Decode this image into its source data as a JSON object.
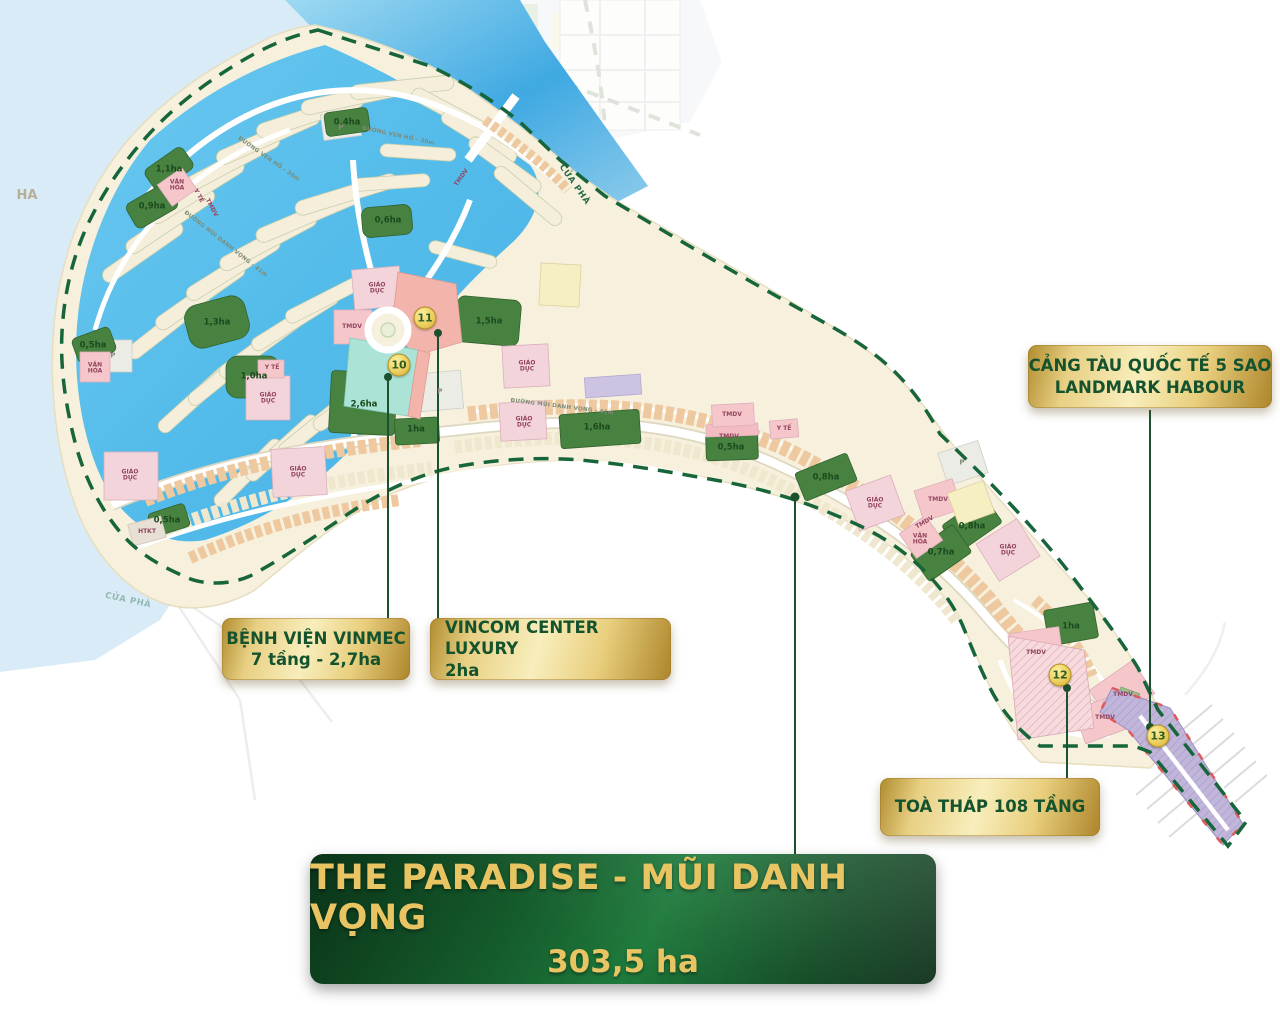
{
  "banner": {
    "title": "THE PARADISE - MŨI DANH VỌNG",
    "area": "303,5 ha"
  },
  "callouts": {
    "port": {
      "line1": "CẢNG TÀU QUỐC TẾ 5 SAO",
      "line2": "LANDMARK HABOUR"
    },
    "hospital": {
      "line1": "BỆNH VIỆN VINMEC",
      "line2": "7 tầng - 2,7ha"
    },
    "vincom": {
      "line1": "VINCOM CENTER LUXURY",
      "line2": "2ha"
    },
    "tower": {
      "line1": "TOÀ THÁP 108 TẦNG"
    }
  },
  "colors": {
    "badge_gold": "#e9cf7e",
    "badge_text": "#14532d",
    "banner_green": "#155c2c",
    "banner_text": "#e9c463",
    "boundary_green": "#17653a",
    "lagoon_blue": "#58bfec",
    "land_cream": "#f6f0dd",
    "leader_green": "#1c5130"
  },
  "map": {
    "markers": [
      {
        "label": "10",
        "x": 399,
        "y": 365
      },
      {
        "label": "11",
        "x": 425,
        "y": 318
      },
      {
        "label": "12",
        "x": 1060,
        "y": 675
      },
      {
        "label": "13",
        "x": 1158,
        "y": 736
      }
    ],
    "labels": [
      {
        "t": "1,1ha",
        "x": 169,
        "y": 170,
        "c": "green"
      },
      {
        "t": "0,9ha",
        "x": 152,
        "y": 207,
        "c": "green"
      },
      {
        "t": "0,4ha",
        "x": 347,
        "y": 123,
        "c": "green"
      },
      {
        "t": "0,6ha",
        "x": 388,
        "y": 221,
        "c": "green"
      },
      {
        "t": "1,3ha",
        "x": 217,
        "y": 323,
        "c": "green"
      },
      {
        "t": "1,5ha",
        "x": 489,
        "y": 322,
        "c": "green"
      },
      {
        "t": "2,6ha",
        "x": 364,
        "y": 405,
        "c": "green"
      },
      {
        "t": "1,0ha",
        "x": 254,
        "y": 377,
        "c": "green"
      },
      {
        "t": "0,5ha",
        "x": 93,
        "y": 346,
        "c": "green"
      },
      {
        "t": "0,5ha",
        "x": 167,
        "y": 521,
        "c": "green"
      },
      {
        "t": "1ha",
        "x": 416,
        "y": 430,
        "c": "green"
      },
      {
        "t": "1,6ha",
        "x": 597,
        "y": 428,
        "c": "green"
      },
      {
        "t": "0,5ha",
        "x": 731,
        "y": 448,
        "c": "green"
      },
      {
        "t": "0,8ha",
        "x": 826,
        "y": 478,
        "c": "green"
      },
      {
        "t": "0,8ha",
        "x": 972,
        "y": 527,
        "c": "green"
      },
      {
        "t": "0,7ha",
        "x": 941,
        "y": 553,
        "c": "green"
      },
      {
        "t": "1ha",
        "x": 1071,
        "y": 627,
        "c": "green"
      },
      {
        "t": "VĂN HÓA",
        "x": 177,
        "y": 186,
        "c": "pink"
      },
      {
        "t": "Y TẾ",
        "x": 198,
        "y": 196,
        "c": "pink",
        "r": 62
      },
      {
        "t": "TMDV",
        "x": 211,
        "y": 208,
        "c": "pink",
        "r": 62
      },
      {
        "t": "TMDV",
        "x": 352,
        "y": 327,
        "c": "pink"
      },
      {
        "t": "TMDV",
        "x": 462,
        "y": 178,
        "c": "pink",
        "r": -55
      },
      {
        "t": "GIÁO DỤC",
        "x": 377,
        "y": 289,
        "c": "pink"
      },
      {
        "t": "GIÁO DỤC",
        "x": 527,
        "y": 367,
        "c": "pink"
      },
      {
        "t": "GIÁO DỤC",
        "x": 524,
        "y": 423,
        "c": "pink"
      },
      {
        "t": "GIÁO DỤC",
        "x": 130,
        "y": 476,
        "c": "pink"
      },
      {
        "t": "GIÁO DỤC",
        "x": 298,
        "y": 473,
        "c": "pink"
      },
      {
        "t": "GIÁO DỤC",
        "x": 268,
        "y": 399,
        "c": "pink"
      },
      {
        "t": "Y TẾ",
        "x": 272,
        "y": 368,
        "c": "pink"
      },
      {
        "t": "VĂN HÓA",
        "x": 95,
        "y": 369,
        "c": "pink"
      },
      {
        "t": "GIÁO DỤC",
        "x": 875,
        "y": 504,
        "c": "pink"
      },
      {
        "t": "TMDV",
        "x": 925,
        "y": 523,
        "c": "pink",
        "r": -30
      },
      {
        "t": "VĂN HÓA",
        "x": 920,
        "y": 540,
        "c": "pink"
      },
      {
        "t": "TMDV",
        "x": 938,
        "y": 500,
        "c": "pink"
      },
      {
        "t": "GIÁO DỤC",
        "x": 1008,
        "y": 551,
        "c": "pink"
      },
      {
        "t": "TMDV",
        "x": 732,
        "y": 415,
        "c": "pink"
      },
      {
        "t": "TMDV",
        "x": 729,
        "y": 437,
        "c": "pink"
      },
      {
        "t": "Y TẾ",
        "x": 784,
        "y": 429,
        "c": "pink"
      },
      {
        "t": "TMDV",
        "x": 1036,
        "y": 653,
        "c": "pink"
      },
      {
        "t": "TMDV",
        "x": 1123,
        "y": 695,
        "c": "pink"
      },
      {
        "t": "TMDV",
        "x": 1105,
        "y": 718,
        "c": "pink"
      },
      {
        "t": "HTKT",
        "x": 147,
        "y": 532,
        "c": "pink"
      },
      {
        "t": "P",
        "x": 341,
        "y": 128,
        "c": "gray"
      },
      {
        "t": "P",
        "x": 440,
        "y": 392,
        "c": "gray"
      },
      {
        "t": "P",
        "x": 113,
        "y": 356,
        "c": "gray"
      },
      {
        "t": "P",
        "x": 962,
        "y": 463,
        "c": "gray"
      },
      {
        "t": "ĐƯỜNG VEN HỒ - 30m",
        "x": 268,
        "y": 160,
        "c": "road",
        "r": 35
      },
      {
        "t": "ĐƯỜNG VEN HỒ - 30m",
        "x": 398,
        "y": 137,
        "c": "road",
        "r": 12
      },
      {
        "t": "ĐƯỜNG MŨI DANH VỌNG - 41m",
        "x": 562,
        "y": 408,
        "c": "road",
        "r": 7
      },
      {
        "t": "ĐƯỜNG MŨI DANH VỌNG - 41m",
        "x": 225,
        "y": 245,
        "c": "road",
        "r": 38
      },
      {
        "t": "CỬA PHÀ",
        "x": 574,
        "y": 185,
        "c": "water",
        "r": 55
      },
      {
        "t": "CỬA PHÀ",
        "x": 128,
        "y": 601,
        "c": "water ghost",
        "r": 12
      },
      {
        "t": "HA",
        "x": 27,
        "y": 196,
        "c": "ghostpill"
      }
    ]
  }
}
